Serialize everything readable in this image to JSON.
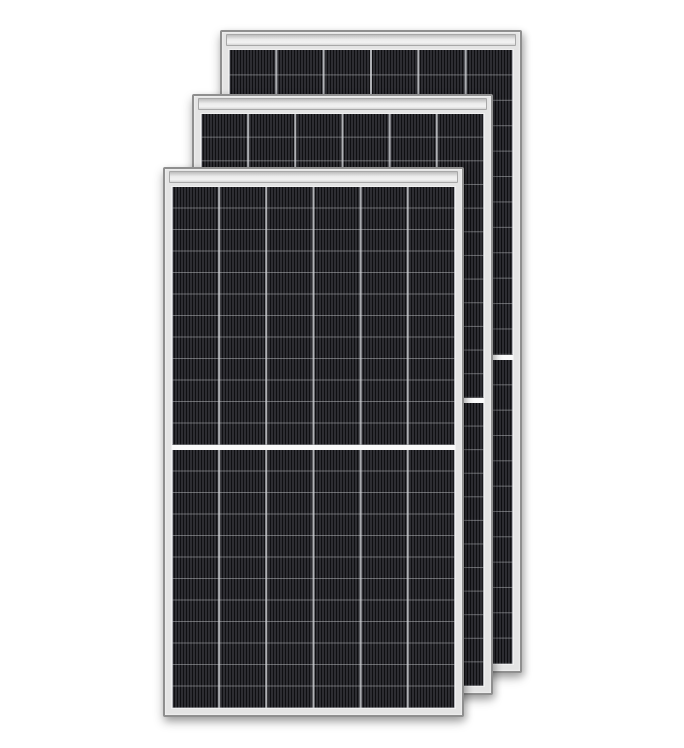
{
  "scene": {
    "alt_text": "Three black monocrystalline half-cut-cell solar PV panels with silver aluminium frames, overlapped in a stepped stack from back-right to front-left on a white background",
    "background_color": "#ffffff",
    "canvas": {
      "width": 684,
      "height": 748
    }
  },
  "colors": {
    "frame_fill": "#e4e4e4",
    "frame_edge": "#8f8f8f",
    "cell_bg": "#1d1d21",
    "stripe_light": "#2d2d32",
    "stripe_dark": "#0f0f12",
    "col_line": "rgba(214,216,220,0.78)",
    "row_line": "rgba(200,202,206,0.45)",
    "divider": "#fafafa"
  },
  "panels": [
    {
      "name": "solar-panel-back",
      "left": 220,
      "top": 30,
      "width": 302,
      "height": 643,
      "columns": 6,
      "rows_per_half": 12
    },
    {
      "name": "solar-panel-middle",
      "left": 192,
      "top": 94,
      "width": 301,
      "height": 601,
      "columns": 6,
      "rows_per_half": 12
    },
    {
      "name": "solar-panel-front",
      "left": 163,
      "top": 167,
      "width": 301,
      "height": 550,
      "columns": 6,
      "rows_per_half": 12
    }
  ]
}
